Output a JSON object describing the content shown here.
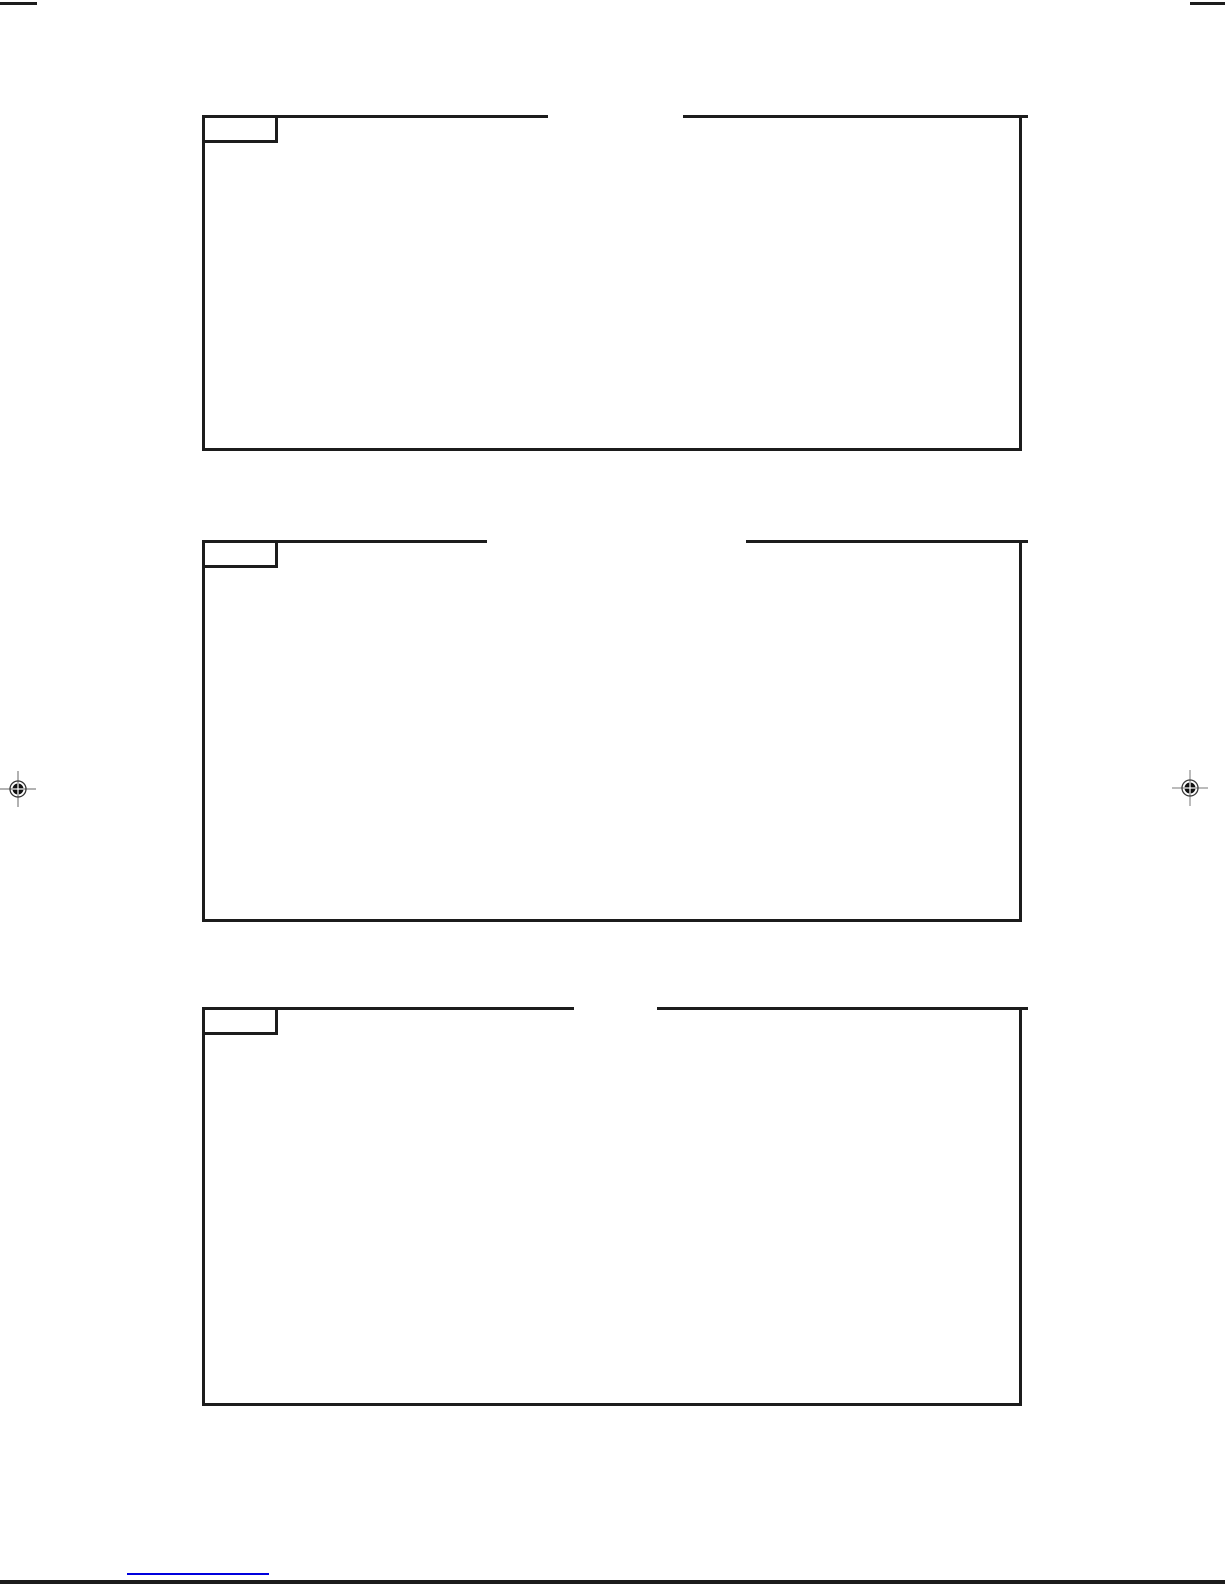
{
  "colors": {
    "ink": "#1c1c1c",
    "reg": "#555555",
    "link_blue": "#0000dd",
    "paper": "#ffffff"
  },
  "figure_boxes": [
    {
      "label": ""
    },
    {
      "label": ""
    },
    {
      "label": ""
    }
  ],
  "footer": {
    "link_text": ""
  }
}
